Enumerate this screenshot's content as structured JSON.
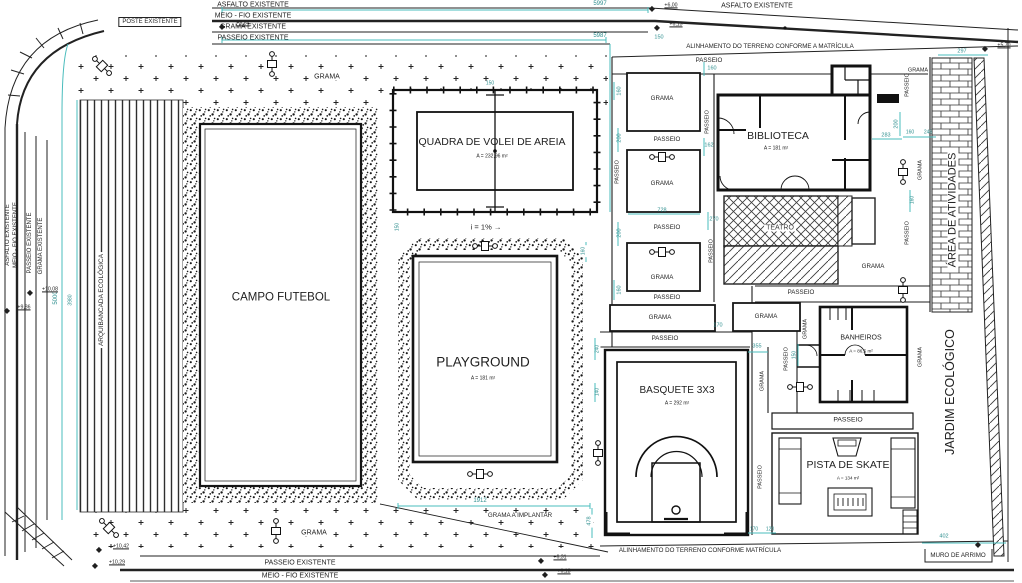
{
  "colors": {
    "ink": "#1f1f1f",
    "dim": "#2f8f8f",
    "gray": "#3c3c3c",
    "teal": "#49bcbc"
  },
  "annotations": {
    "street_top": [
      {
        "n": "asfalto-existente-top",
        "t": "ASFALTO EXISTENTE",
        "x": 253,
        "y": 5,
        "s": 7
      },
      {
        "n": "meio-fio-existente-top",
        "t": "MEIO - FIO EXISTENTE",
        "x": 253,
        "y": 16,
        "s": 7
      },
      {
        "n": "grama-existente-top",
        "t": "GRAMA EXISTENTE",
        "x": 253,
        "y": 27,
        "s": 7
      },
      {
        "n": "passeio-existente-top",
        "t": "PASSEIO EXISTENTE",
        "x": 253,
        "y": 38,
        "s": 7
      },
      {
        "n": "poste-existente",
        "t": "POSTE EXISTENTE",
        "x": 150,
        "y": 22,
        "s": 6,
        "box": true
      },
      {
        "n": "asfalto-existente-top-right",
        "t": "ASFALTO EXISTENTE",
        "x": 757,
        "y": 6,
        "s": 7
      },
      {
        "n": "alinhamento-terreno-top",
        "t": "ALINHAMENTO DO TERRENO CONFORME A MATRÍCULA",
        "x": 770,
        "y": 47,
        "s": 6.2
      }
    ],
    "street_left": [
      {
        "n": "asfalto-existente-left",
        "t": "ASFALTO EXISTENTE",
        "x": 8,
        "y": 235,
        "r": -90,
        "s": 6
      },
      {
        "n": "meio-fio-existente-left",
        "t": "MEIO - FIO EXISTENTE",
        "x": 16,
        "y": 235,
        "r": -90,
        "s": 6
      },
      {
        "n": "passeio-existente-left",
        "t": "PASSEIO EXISTENTE",
        "x": 30,
        "y": 243,
        "r": -90,
        "s": 6
      },
      {
        "n": "grama-existente-left",
        "t": "GRAMA EXISTENTE",
        "x": 41,
        "y": 246,
        "r": -90,
        "s": 6
      },
      {
        "n": "arquibancada-ecologica",
        "t": "ARQUIBANCADA ECOLÓGICA",
        "x": 102,
        "y": 300,
        "r": -90,
        "s": 6.5,
        "bg": true
      }
    ],
    "street_bottom": [
      {
        "n": "passeio-existente-bottom",
        "t": "PASSEIO EXISTENTE",
        "x": 300,
        "y": 563,
        "s": 7
      },
      {
        "n": "meio-fio-existente-bottom",
        "t": "MEIO - FIO EXISTENTE",
        "x": 300,
        "y": 576,
        "s": 7
      },
      {
        "n": "alinhamento-terreno-bottom",
        "t": "ALINHAMENTO DO TERRENO CONFORME MATRÍCULA",
        "x": 700,
        "y": 551,
        "s": 6.2
      },
      {
        "n": "muro-de-arrimo",
        "t": "MURO DE ARRIMO",
        "x": 958,
        "y": 556,
        "s": 6.2
      }
    ],
    "areas": [
      {
        "n": "campo-futebol",
        "t": "CAMPO FUTEBOL",
        "x": 281,
        "y": 298,
        "s": 11.5
      },
      {
        "n": "quadra-volei",
        "t": "QUADRA DE VOLEI DE AREIA",
        "x": 492,
        "y": 142,
        "s": 10.5
      },
      {
        "n": "quadra-volei-area",
        "t": "A = 232,96 m²",
        "x": 492,
        "y": 157,
        "s": 5
      },
      {
        "n": "playground",
        "t": "PLAYGROUND",
        "x": 483,
        "y": 362,
        "s": 13.5
      },
      {
        "n": "playground-area",
        "t": "A = 181 m²",
        "x": 483,
        "y": 379,
        "s": 5
      },
      {
        "n": "basquete-3x3",
        "t": "BASQUETE 3X3",
        "x": 677,
        "y": 391,
        "s": 10
      },
      {
        "n": "basquete-area",
        "t": "A = 292 m²",
        "x": 677,
        "y": 404,
        "s": 5
      },
      {
        "n": "biblioteca",
        "t": "BIBLIOTECA",
        "x": 778,
        "y": 136,
        "s": 10.5
      },
      {
        "n": "biblioteca-area",
        "t": "A = 181 m²",
        "x": 776,
        "y": 149,
        "s": 5
      },
      {
        "n": "teatro",
        "t": "TEATRO",
        "x": 780,
        "y": 228,
        "s": 7,
        "c": "gray",
        "bg": true
      },
      {
        "n": "banheiros",
        "t": "BANHEIROS",
        "x": 861,
        "y": 338,
        "s": 7
      },
      {
        "n": "banheiros-area",
        "t": "A = 86,5 m²",
        "x": 861,
        "y": 352,
        "s": 4.6
      },
      {
        "n": "pista-de-skate",
        "t": "PISTA DE SKATE",
        "x": 848,
        "y": 465,
        "s": 10.5
      },
      {
        "n": "pista-de-skate-area",
        "t": "A = 134 m²",
        "x": 848,
        "y": 479,
        "s": 4.6
      },
      {
        "n": "area-de-atividades",
        "t": "ÁREA DE ATIVIDADES",
        "x": 953,
        "y": 210,
        "r": -90,
        "s": 11,
        "bg": true
      },
      {
        "n": "jardim-ecologico",
        "t": "JARDIM ECOLÓGICO",
        "x": 950,
        "y": 392,
        "r": -90,
        "s": 12.5
      },
      {
        "n": "slope-note",
        "t": "i = 1% →",
        "x": 486,
        "y": 227,
        "s": 7.5
      }
    ],
    "grama": [
      {
        "n": "grama-label",
        "t": "GRAMA",
        "x": 327,
        "y": 77,
        "s": 7,
        "bg": true
      },
      {
        "n": "grama-label",
        "t": "GRAMA",
        "x": 918,
        "y": 71,
        "s": 5.5
      },
      {
        "n": "grama-label",
        "t": "GRAMA",
        "x": 662,
        "y": 99,
        "s": 6.2
      },
      {
        "n": "grama-label",
        "t": "GRAMA",
        "x": 662,
        "y": 184,
        "s": 6.2
      },
      {
        "n": "grama-label",
        "t": "GRAMA",
        "x": 662,
        "y": 278,
        "s": 6.2
      },
      {
        "n": "grama-label",
        "t": "GRAMA",
        "x": 660,
        "y": 318,
        "s": 6.2
      },
      {
        "n": "grama-label",
        "t": "GRAMA",
        "x": 766,
        "y": 317,
        "s": 6.2
      },
      {
        "n": "grama-label",
        "t": "GRAMA",
        "x": 873,
        "y": 267,
        "s": 6.2
      },
      {
        "n": "grama-label",
        "t": "GRAMA",
        "x": 314,
        "y": 533,
        "s": 7,
        "bg": true
      },
      {
        "n": "grama-a-implantar",
        "t": "GRAMA A IMPLANTAR",
        "x": 520,
        "y": 516,
        "s": 6.2,
        "bg": true
      },
      {
        "n": "grama-label",
        "t": "GRAMA",
        "x": 806,
        "y": 329,
        "r": -90,
        "s": 5.5
      },
      {
        "n": "grama-label",
        "t": "GRAMA",
        "x": 921,
        "y": 357,
        "r": -90,
        "s": 5.5
      },
      {
        "n": "grama-label",
        "t": "GRAMA",
        "x": 763,
        "y": 381,
        "r": -90,
        "s": 5.5
      },
      {
        "n": "grama-label",
        "t": "GRAMA",
        "x": 921,
        "y": 170,
        "r": -90,
        "s": 5.5
      }
    ],
    "passeio": [
      {
        "n": "passeio-label",
        "t": "PASSEIO",
        "x": 709,
        "y": 61,
        "s": 6.2
      },
      {
        "n": "passeio-label",
        "t": "PASSEIO",
        "x": 667,
        "y": 140,
        "s": 6.2
      },
      {
        "n": "passeio-label",
        "t": "PASSEIO",
        "x": 667,
        "y": 228,
        "s": 6.2
      },
      {
        "n": "passeio-label",
        "t": "PASSEIO",
        "x": 667,
        "y": 298,
        "s": 6.2
      },
      {
        "n": "passeio-label",
        "t": "PASSEIO",
        "x": 665,
        "y": 339,
        "s": 6.2
      },
      {
        "n": "passeio-label",
        "t": "PASSEIO",
        "x": 801,
        "y": 293,
        "s": 6.2
      },
      {
        "n": "passeio-label",
        "t": "PASSEIO",
        "x": 848,
        "y": 421,
        "s": 6.8
      },
      {
        "n": "passeio-label",
        "t": "PASSEIO",
        "x": 618,
        "y": 172,
        "r": -90,
        "s": 5.5
      },
      {
        "n": "passeio-label",
        "t": "PASSEIO",
        "x": 708,
        "y": 122,
        "r": -90,
        "s": 5.5
      },
      {
        "n": "passeio-label",
        "t": "PASSEIO",
        "x": 712,
        "y": 251,
        "r": -90,
        "s": 5.5
      },
      {
        "n": "passeio-label",
        "t": "PASSEIO",
        "x": 787,
        "y": 359,
        "r": -90,
        "s": 5.5
      },
      {
        "n": "passeio-label",
        "t": "PASSEIO",
        "x": 761,
        "y": 477,
        "r": -90,
        "s": 5.5
      },
      {
        "n": "passeio-label",
        "t": "PASSEIO",
        "x": 908,
        "y": 85,
        "r": -90,
        "s": 5.5
      },
      {
        "n": "passeio-label",
        "t": "PASSEIO",
        "x": 908,
        "y": 233,
        "r": -90,
        "s": 5.5
      }
    ],
    "dims": [
      {
        "n": "dim-label",
        "t": "5997",
        "x": 600,
        "y": 4,
        "s": 6,
        "c": "dim"
      },
      {
        "n": "dim-label",
        "t": "5987",
        "x": 600,
        "y": 36,
        "s": 6,
        "c": "dim"
      },
      {
        "n": "dim-label",
        "t": "150",
        "x": 659,
        "y": 38,
        "s": 5.5,
        "c": "dim"
      },
      {
        "n": "dim-label",
        "t": "160",
        "x": 712,
        "y": 69,
        "s": 5.5,
        "c": "dim"
      },
      {
        "n": "dim-label",
        "t": "728",
        "x": 662,
        "y": 211,
        "s": 5.5,
        "c": "dim"
      },
      {
        "n": "dim-label",
        "t": "200",
        "x": 620,
        "y": 138,
        "r": -90,
        "s": 5.5,
        "c": "dim"
      },
      {
        "n": "dim-label",
        "t": "200",
        "x": 620,
        "y": 233,
        "r": -90,
        "s": 5.5,
        "c": "dim"
      },
      {
        "n": "dim-label",
        "t": "160",
        "x": 620,
        "y": 91,
        "r": -90,
        "s": 5.5,
        "c": "dim"
      },
      {
        "n": "dim-label",
        "t": "160",
        "x": 620,
        "y": 290,
        "r": -90,
        "s": 5.5,
        "c": "dim"
      },
      {
        "n": "dim-label",
        "t": "162",
        "x": 709,
        "y": 146,
        "s": 5.5,
        "c": "dim"
      },
      {
        "n": "dim-label",
        "t": "270",
        "x": 714,
        "y": 220,
        "s": 5.5,
        "c": "dim"
      },
      {
        "n": "dim-label",
        "t": "283",
        "x": 886,
        "y": 136,
        "s": 5.5,
        "c": "dim"
      },
      {
        "n": "dim-label",
        "t": "200",
        "x": 897,
        "y": 124,
        "r": -90,
        "s": 5.5,
        "c": "dim"
      },
      {
        "n": "dim-label",
        "t": "297",
        "x": 962,
        "y": 52,
        "s": 5.5,
        "c": "dim"
      },
      {
        "n": "dim-label",
        "t": "160",
        "x": 910,
        "y": 133,
        "s": 5,
        "c": "dim"
      },
      {
        "n": "dim-label",
        "t": "246",
        "x": 928,
        "y": 133,
        "s": 5,
        "c": "dim"
      },
      {
        "n": "dim-label",
        "t": "160",
        "x": 913,
        "y": 200,
        "r": -90,
        "s": 5,
        "c": "dim"
      },
      {
        "n": "dim-label",
        "t": "355",
        "x": 757,
        "y": 347,
        "s": 5.5,
        "c": "dim"
      },
      {
        "n": "dim-label",
        "t": "240",
        "x": 598,
        "y": 349,
        "r": -90,
        "s": 5,
        "c": "dim",
        "bg": true
      },
      {
        "n": "dim-label",
        "t": "140",
        "x": 598,
        "y": 392,
        "r": -90,
        "s": 5,
        "c": "dim",
        "bg": true
      },
      {
        "n": "dim-label",
        "t": "170",
        "x": 754,
        "y": 530,
        "s": 5,
        "c": "dim"
      },
      {
        "n": "dim-label",
        "t": "120",
        "x": 770,
        "y": 530,
        "s": 5,
        "c": "dim"
      },
      {
        "n": "dim-label",
        "t": "150",
        "x": 795,
        "y": 355,
        "r": -90,
        "s": 5,
        "c": "dim"
      },
      {
        "n": "dim-label",
        "t": "1912",
        "x": 480,
        "y": 501,
        "s": 6,
        "c": "dim",
        "bg": true
      },
      {
        "n": "dim-label",
        "t": "478",
        "x": 590,
        "y": 521,
        "r": -90,
        "s": 5.5,
        "c": "dim",
        "bg": true
      },
      {
        "n": "dim-label",
        "t": "402",
        "x": 944,
        "y": 537,
        "s": 5.5,
        "c": "dim"
      },
      {
        "n": "dim-label",
        "t": "170",
        "x": 718,
        "y": 326,
        "s": 5.5,
        "c": "dim"
      },
      {
        "n": "dim-label",
        "t": "160",
        "x": 584,
        "y": 251,
        "r": -90,
        "s": 5,
        "c": "dim",
        "bg": true
      },
      {
        "n": "dim-label",
        "t": "150",
        "x": 398,
        "y": 227,
        "r": -90,
        "s": 5,
        "c": "dim",
        "bg": true
      },
      {
        "n": "dim-label",
        "t": "150",
        "x": 490,
        "y": 84,
        "s": 5,
        "c": "dim"
      },
      {
        "n": "dim-label",
        "t": "5000",
        "x": 56,
        "y": 298,
        "r": -90,
        "s": 6,
        "c": "dim"
      },
      {
        "n": "dim-label",
        "t": "3980",
        "x": 71,
        "y": 300,
        "r": -90,
        "s": 5,
        "c": "dim"
      }
    ],
    "elevation_markers": [
      {
        "n": "marker-icon",
        "t": "◆",
        "x": 222,
        "y": 27,
        "s": 8
      },
      {
        "n": "marker-label",
        "t": "+8,84",
        "x": 243,
        "y": 24,
        "s": 5.2,
        "u": true
      },
      {
        "n": "marker-icon",
        "t": "◆",
        "x": 30,
        "y": 293,
        "s": 8
      },
      {
        "n": "marker-label",
        "t": "+10,08",
        "x": 50,
        "y": 290,
        "s": 5.2,
        "u": true
      },
      {
        "n": "marker-icon",
        "t": "◆",
        "x": 7,
        "y": 311,
        "s": 8
      },
      {
        "n": "marker-label",
        "t": "+9,86",
        "x": 24,
        "y": 308,
        "s": 5.2,
        "u": true
      },
      {
        "n": "marker-icon",
        "t": "◆",
        "x": 99,
        "y": 550,
        "s": 8
      },
      {
        "n": "marker-label",
        "t": "+10,42",
        "x": 121,
        "y": 547,
        "s": 5.2,
        "u": true
      },
      {
        "n": "marker-icon",
        "t": "◆",
        "x": 95,
        "y": 566,
        "s": 8
      },
      {
        "n": "marker-label",
        "t": "+10,29",
        "x": 117,
        "y": 563,
        "s": 5.2,
        "u": true
      },
      {
        "n": "marker-icon",
        "t": "◆",
        "x": 652,
        "y": 9,
        "s": 8
      },
      {
        "n": "marker-label",
        "t": "+6,00",
        "x": 671,
        "y": 6,
        "s": 5.2,
        "u": true
      },
      {
        "n": "marker-icon",
        "t": "◆",
        "x": 657,
        "y": 28,
        "s": 8
      },
      {
        "n": "marker-label",
        "t": "+6,13",
        "x": 676,
        "y": 25,
        "s": 5.2,
        "u": true
      },
      {
        "n": "marker-icon",
        "t": "◆",
        "x": 985,
        "y": 49,
        "s": 8
      },
      {
        "n": "marker-label",
        "t": "+5,70",
        "x": 1004,
        "y": 46,
        "s": 5.2,
        "u": true
      },
      {
        "n": "marker-icon",
        "t": "◆",
        "x": 541,
        "y": 561,
        "s": 8
      },
      {
        "n": "marker-label",
        "t": "+6,31",
        "x": 560,
        "y": 558,
        "s": 5.2,
        "u": true
      },
      {
        "n": "marker-icon",
        "t": "◆",
        "x": 545,
        "y": 575,
        "s": 8
      },
      {
        "n": "marker-label",
        "t": "+6,18",
        "x": 564,
        "y": 572,
        "s": 5.2,
        "u": true
      },
      {
        "n": "marker-icon",
        "t": "◆",
        "x": 978,
        "y": 545,
        "s": 8
      }
    ]
  }
}
